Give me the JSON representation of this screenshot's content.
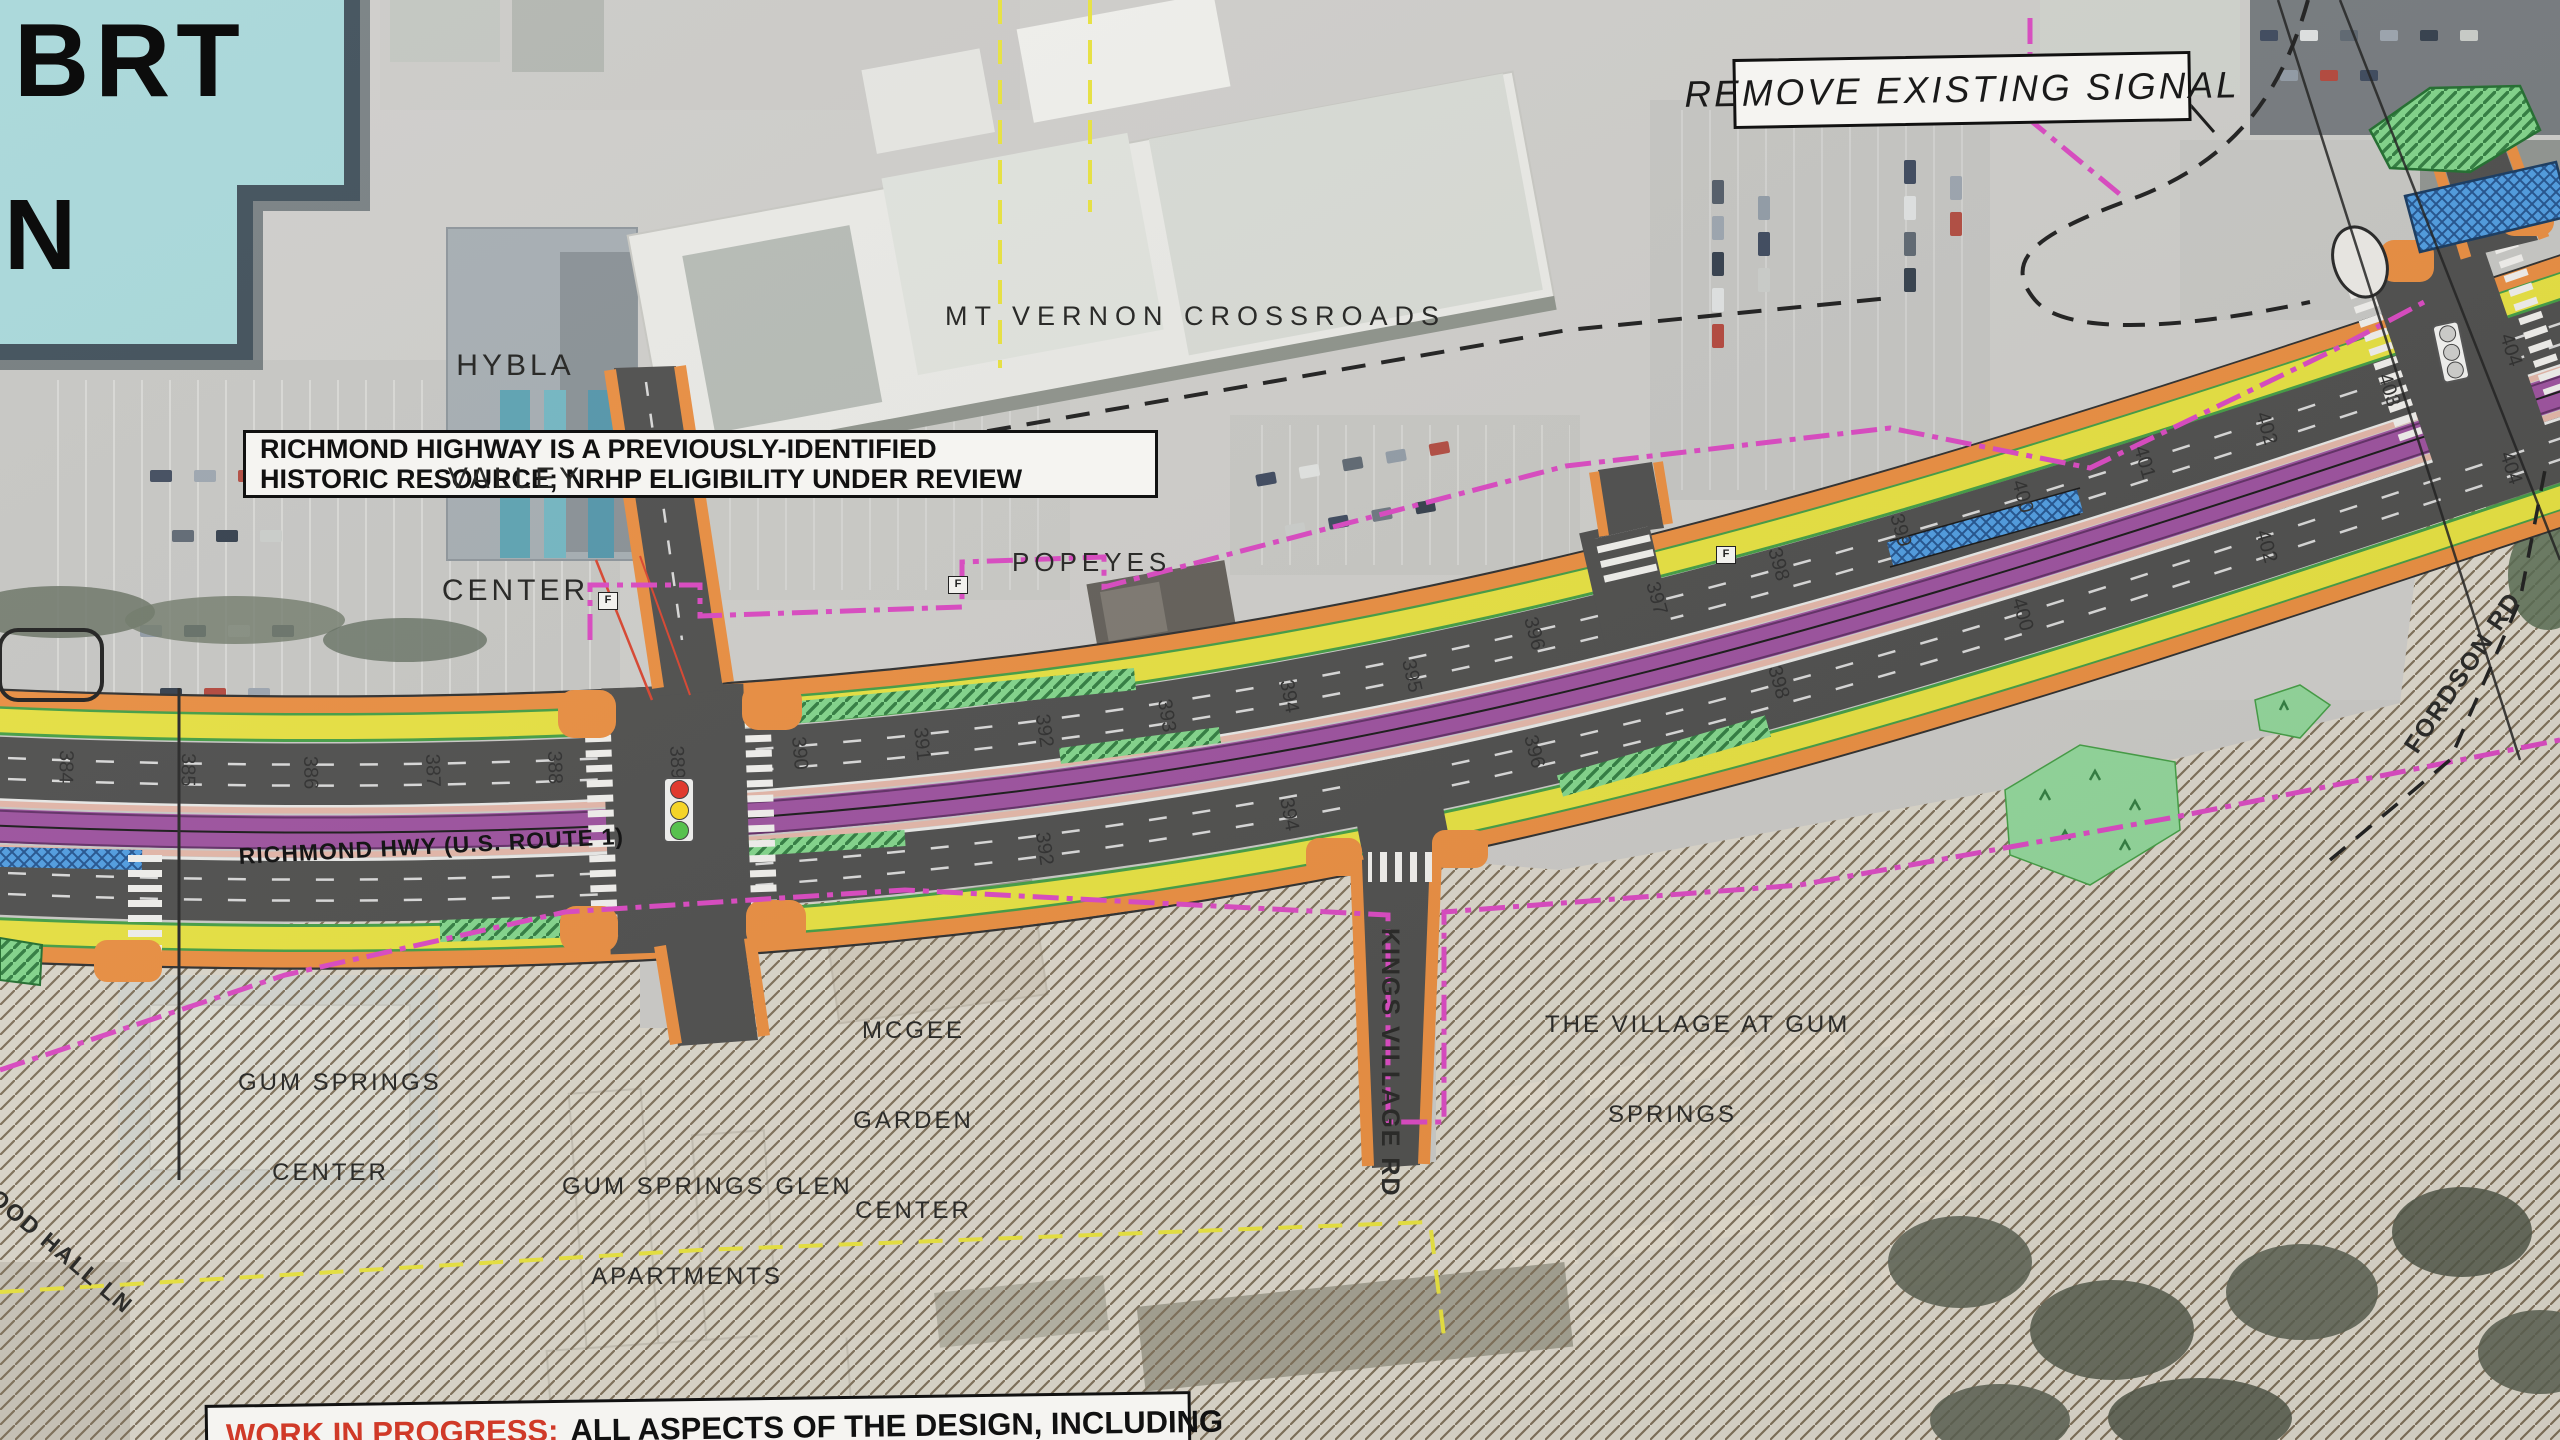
{
  "title_block": {
    "brt": "BRT",
    "north": "N"
  },
  "callouts": {
    "remove_signal": "REMOVE EXISTING SIGNAL",
    "historic_line1": "RICHMOND HIGHWAY IS A PREVIOUSLY-IDENTIFIED",
    "historic_line2": "HISTORIC RESOURCE; NRHP ELIGIBILITY UNDER REVIEW",
    "wip_highlight": "WORK IN PROGRESS:",
    "wip_rest": "ALL ASPECTS OF THE DESIGN, INCLUDING"
  },
  "road_labels": {
    "richmond_hwy": "RICHMOND HWY (U.S. ROUTE 1)",
    "kings_village": "KINGS VILLAGE RD",
    "fordson": "FORDSON RD",
    "wood_hall": "WOOD HALL LN"
  },
  "place_labels": {
    "hybla": [
      "HYBLA",
      "VALLEY",
      "CENTER"
    ],
    "mt_vernon": "MT VERNON CROSSROADS",
    "popeyes": "POPEYES",
    "gum_springs_center": [
      "GUM SPRINGS",
      "CENTER"
    ],
    "mcgee": [
      "MCGEE",
      "GARDEN",
      "CENTER"
    ],
    "gum_springs_glen": [
      "GUM SPRINGS GLEN",
      "APARTMENTS"
    ],
    "village_at_gum_springs": [
      "THE VILLAGE AT GUM",
      "SPRINGS"
    ]
  },
  "survey_flag": "F",
  "stations": [
    "384",
    "385",
    "386",
    "387",
    "388",
    "389",
    "390",
    "391",
    "392",
    "393",
    "394",
    "395",
    "396",
    "397",
    "398",
    "399",
    "400",
    "401",
    "402",
    "403",
    "404"
  ],
  "colors": {
    "brt_purple": "#9a4d9c",
    "bike_lane_yellow": "#e6e03c",
    "curb_orange": "#e98b3c",
    "median_green": "#59c86a",
    "platform_blue": "#3b86d8",
    "lod_magenta": "#d944c0",
    "road_gray": "#4a4a49",
    "hatch_brown": "#7b6c55",
    "signal_red": "#e03a2e",
    "signal_yellow": "#f5d428",
    "signal_green": "#57c14e",
    "wip_red": "#d03a28",
    "title_teal": "#a5d6d8"
  }
}
